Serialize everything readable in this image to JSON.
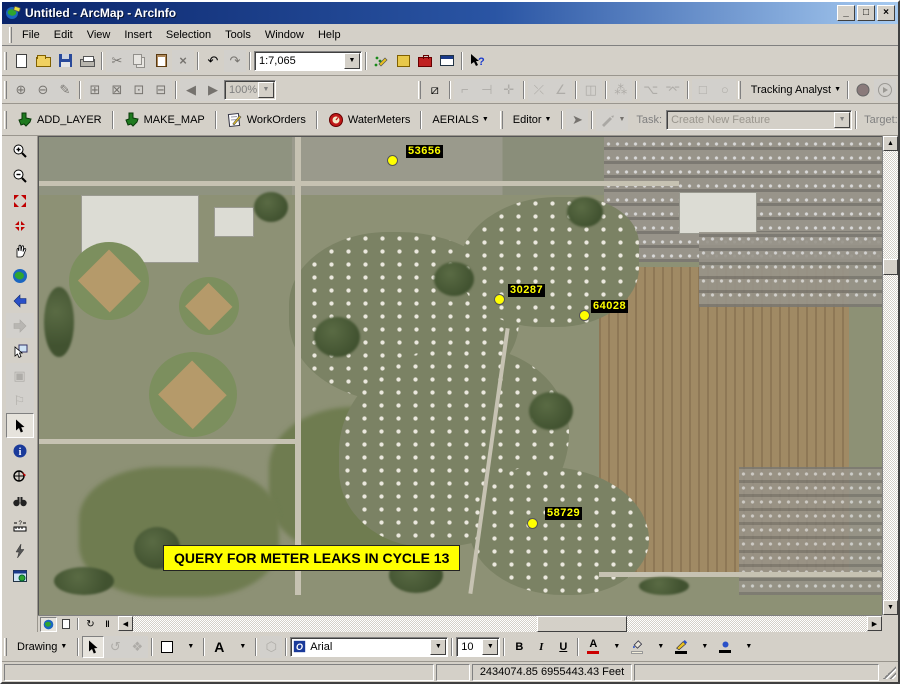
{
  "window": {
    "title": "Untitled - ArcMap - ArcInfo"
  },
  "menu": {
    "items": [
      "File",
      "Edit",
      "View",
      "Insert",
      "Selection",
      "Tools",
      "Window",
      "Help"
    ]
  },
  "standard_toolbar": {
    "scale_value": "1:7,065"
  },
  "zoom_toolbar": {
    "zoom_value": "100%"
  },
  "tracking_toolbar": {
    "label": "Tracking Analyst"
  },
  "custom_toolbar": {
    "add_layer": "ADD_LAYER",
    "make_map": "MAKE_MAP",
    "work_orders": "WorkOrders",
    "water_meters": "WaterMeters",
    "aerials": "AERIALS"
  },
  "editor_toolbar": {
    "editor_label": "Editor",
    "task_label": "Task:",
    "task_value": "Create New Feature",
    "target_label": "Target:"
  },
  "map": {
    "banner": "QUERY FOR METER LEAKS IN CYCLE 13",
    "points": [
      {
        "id": "53656"
      },
      {
        "id": "30287"
      },
      {
        "id": "64028"
      },
      {
        "id": "58729"
      }
    ],
    "label_color": "#ffff00"
  },
  "drawing_toolbar": {
    "menu_label": "Drawing",
    "text_tool": "A",
    "font_value": "Arial",
    "size_value": "10",
    "bold": "B",
    "italic": "I",
    "underline": "U",
    "font_color_glyph": "A"
  },
  "statusbar": {
    "coordinates": "2434074.85  6955443.43 Feet"
  },
  "colors": {
    "accent_yellow": "#ffff00",
    "titlebar_left": "#0a246a",
    "titlebar_right": "#a6caf0",
    "toolbar_face": "#d4d0c8"
  }
}
